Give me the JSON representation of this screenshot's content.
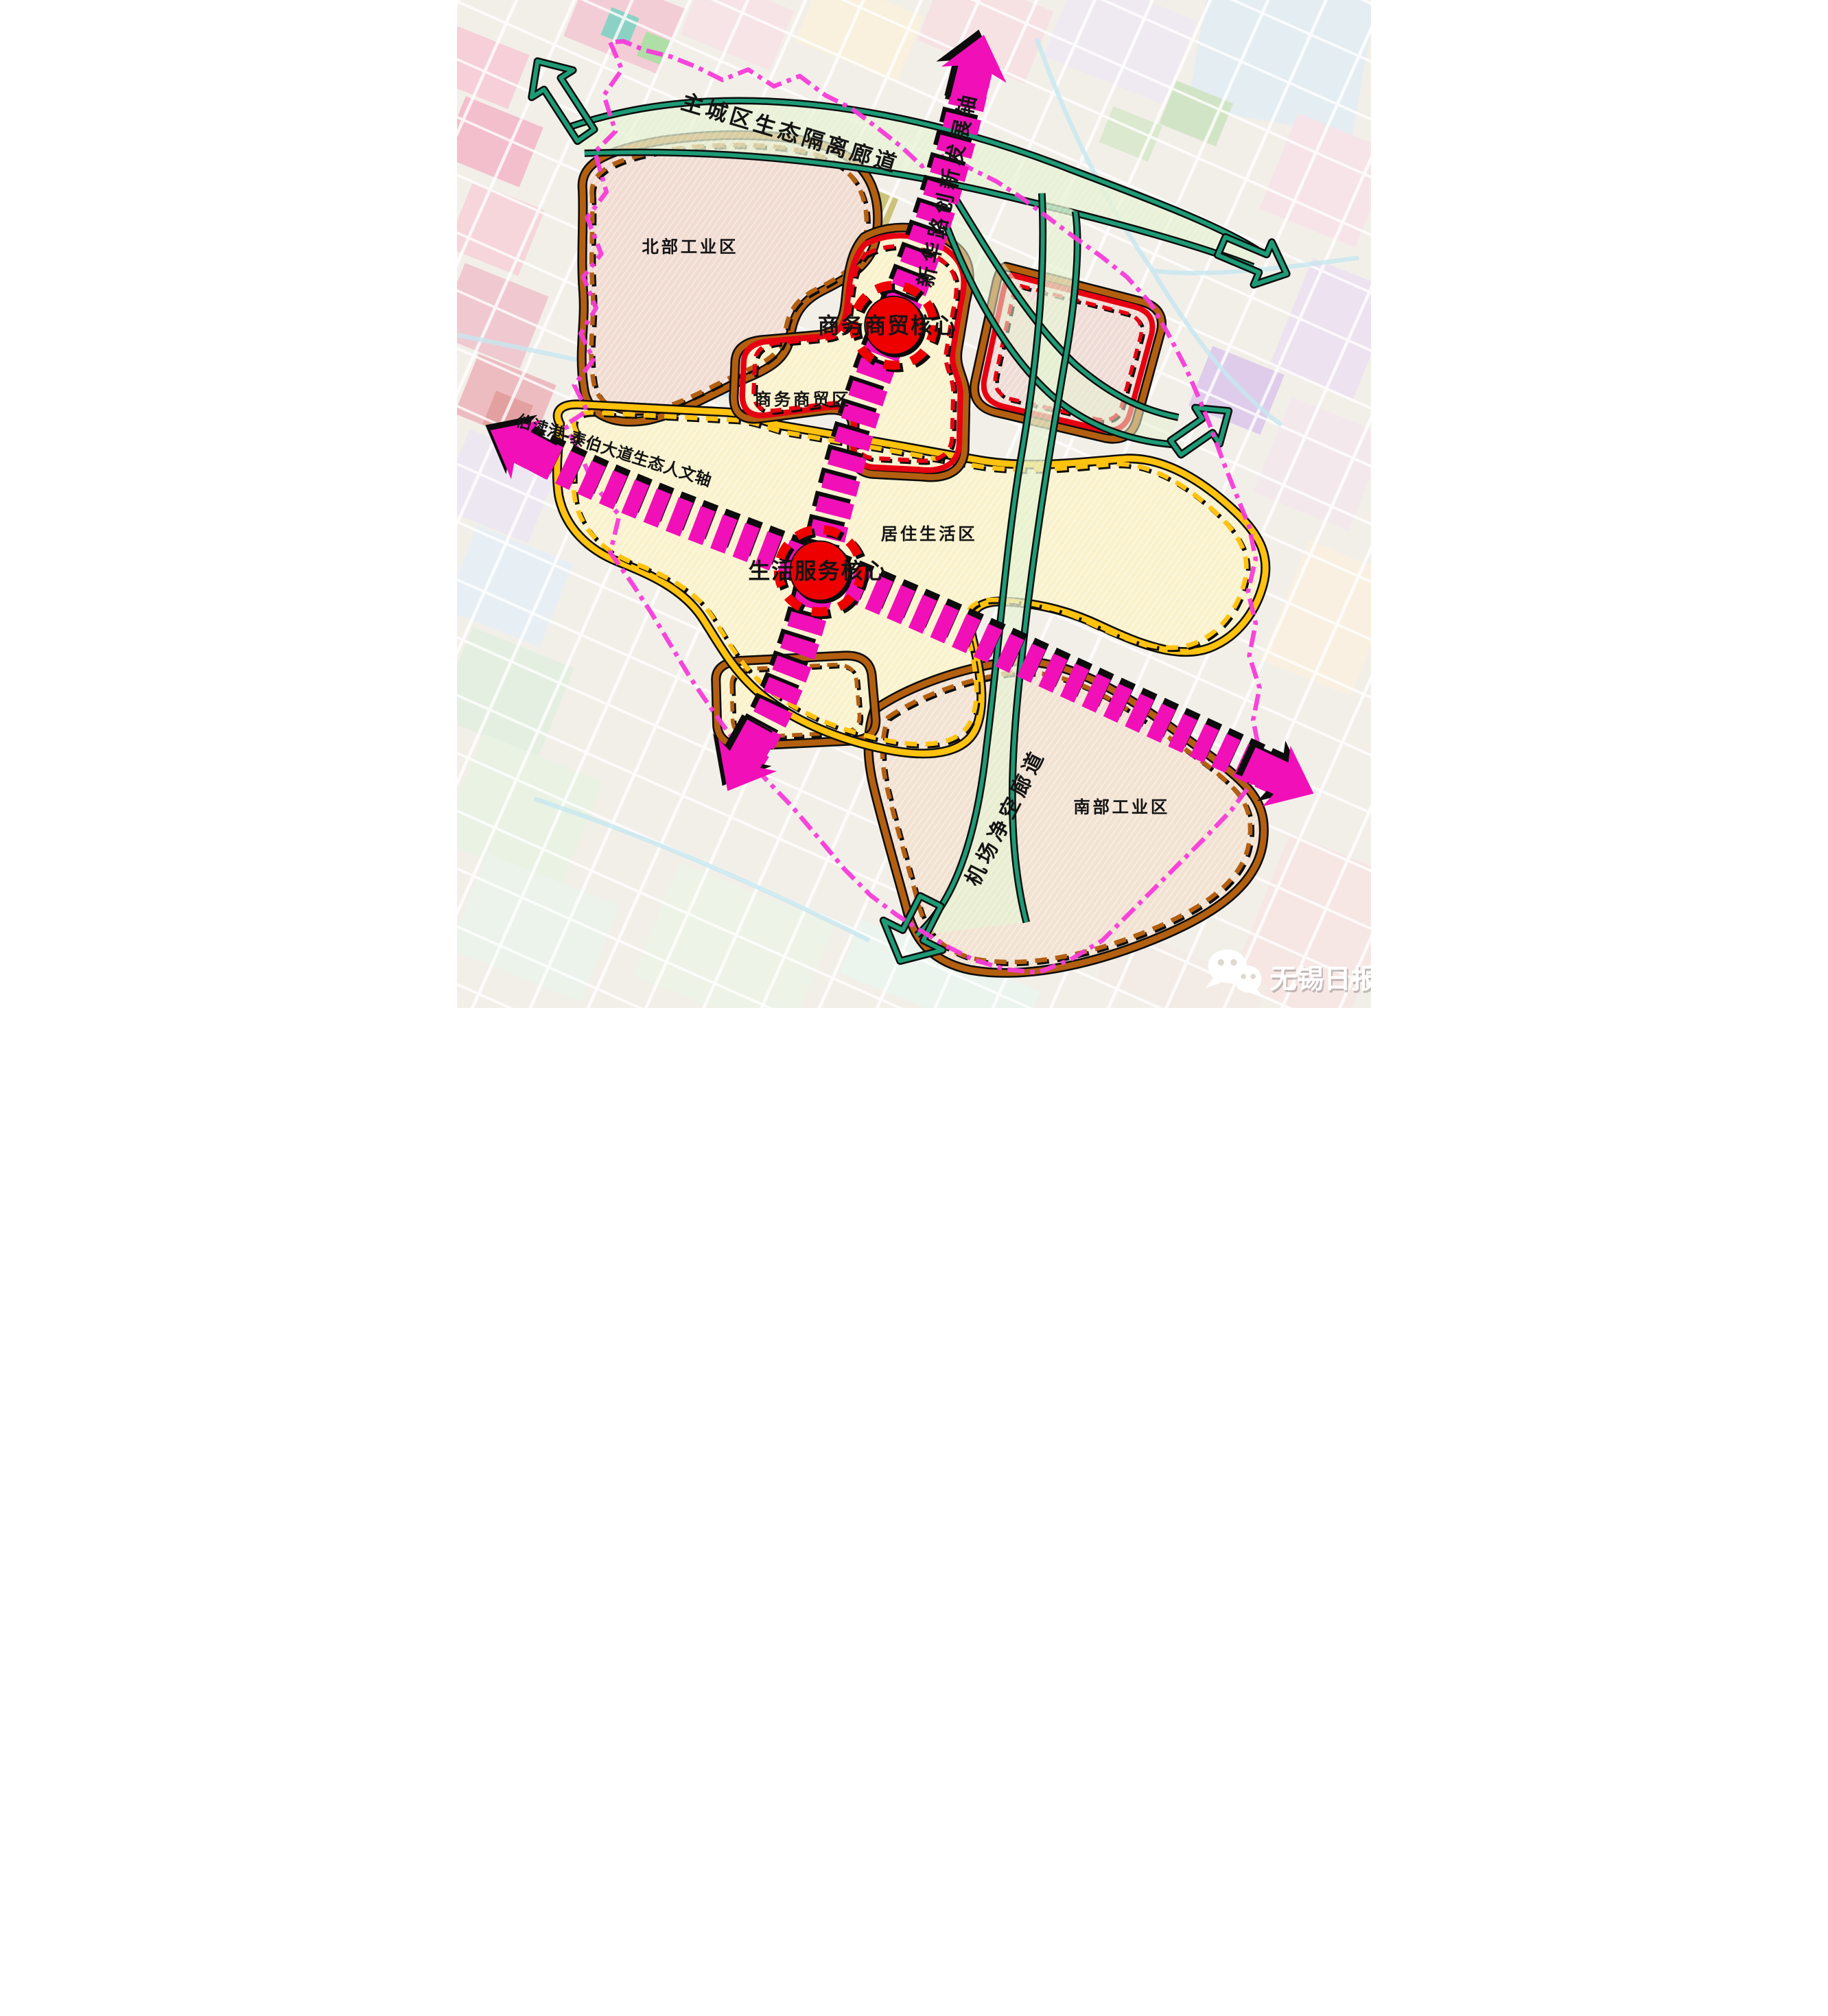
{
  "map": {
    "type": "urban-planning-structure-map",
    "corridors": [
      {
        "id": "main-city-eco-isolation-corridor",
        "label": "主城区生态隔离廊道",
        "color_key": "corridor_teal"
      },
      {
        "id": "airport-clearance-corridor",
        "label": "机场净空廊道",
        "color_key": "corridor_teal"
      }
    ],
    "axes": [
      {
        "id": "xinhua-road-innovation-development-axis",
        "label": "新华路创新发展轴",
        "color_key": "axis_magenta"
      },
      {
        "id": "bodugang-taibo-avenue-eco-humanity-axis",
        "label": "伯渎港-泰伯大道生态人文轴",
        "color_key": "axis_magenta"
      }
    ],
    "zones": [
      {
        "id": "north-industrial-zone",
        "label": "北部工业区",
        "boundary": "brown"
      },
      {
        "id": "business-trade-zone",
        "label": "商务商贸区",
        "boundary": "red"
      },
      {
        "id": "residential-living-zone",
        "label": "居住生活区",
        "boundary": "yellow"
      },
      {
        "id": "south-industrial-zone",
        "label": "南部工业区",
        "boundary": "brown"
      }
    ],
    "cores": [
      {
        "id": "business-trade-core",
        "label": "商务商贸核心",
        "color_key": "core_red"
      },
      {
        "id": "life-service-core",
        "label": "生活服务核心",
        "color_key": "core_red"
      }
    ],
    "watermark": {
      "source": "无锡日报",
      "icon": "wechat-bubbles-icon",
      "color": "#FFFFFF"
    },
    "colors": {
      "axis_magenta": "#F10FB8",
      "boundary_magenta": "#F73BD8",
      "corridor_teal": "#1E9B76",
      "corridor_fill": "#E5F1D2",
      "zone_brown": "#B35F10",
      "zone_red": "#E60012",
      "zone_yellow": "#FFC20E",
      "core_red": "#EE0000",
      "label_black": "#141414",
      "watermark_white": "#FFFFFF"
    }
  }
}
